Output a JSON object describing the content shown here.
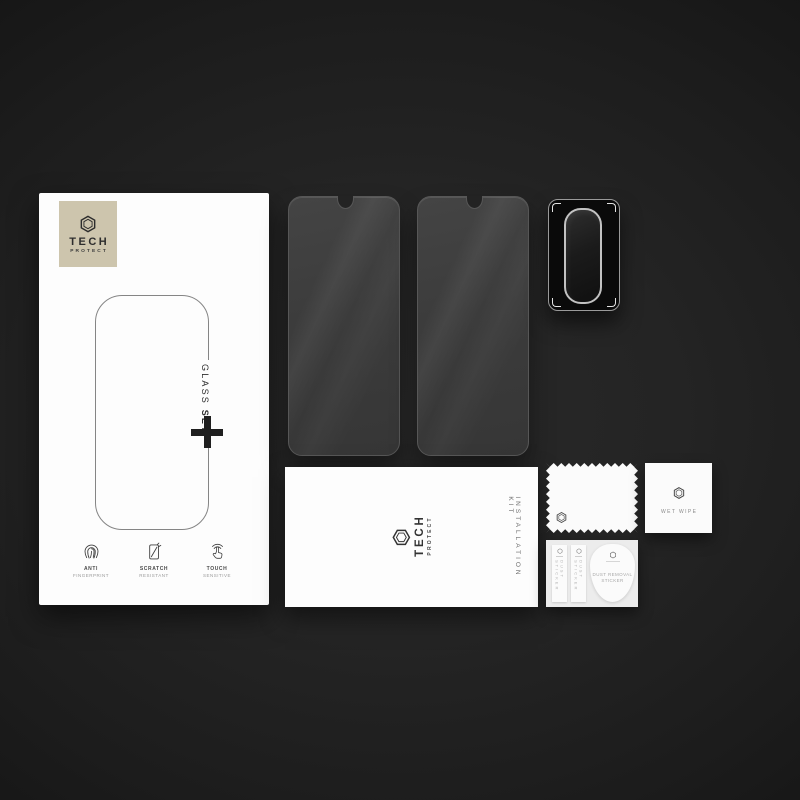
{
  "brand": {
    "line1": "TECH",
    "line2": "PROTECT"
  },
  "box": {
    "product_label_regular": "GLASS ",
    "product_label_bold": "SET",
    "features": [
      {
        "icon": "fingerprint-icon",
        "line1": "ANTI",
        "line2": "FINGERPRINT"
      },
      {
        "icon": "scratch-resistant-icon",
        "line1": "SCRATCH",
        "line2": "RESISTANT"
      },
      {
        "icon": "touch-sensitive-icon",
        "line1": "TOUCH",
        "line2": "SENSITIVE"
      }
    ]
  },
  "installation_kit": {
    "logo_line1": "TECH",
    "logo_line2": "PROTECT",
    "side_label": "INSTALLATION KIT"
  },
  "wet_wipe_packet": {
    "label": "WET WIPE"
  },
  "sticker_sheet": {
    "strips": [
      {
        "label": "DUST STICKER"
      },
      {
        "label": "DUST STICKER"
      }
    ],
    "drop_sticker": {
      "line1": "DUST REMOVAL",
      "line2": "STICKER"
    }
  },
  "colors": {
    "background_center": "#292929",
    "background_edge": "#0a0a0a",
    "logo_plate": "#cdc5ad",
    "box_white": "#fdfdfd",
    "glass_tint": "#3c3c3c",
    "lens_black": "#0a0a0a",
    "outline_gray": "#858585"
  }
}
